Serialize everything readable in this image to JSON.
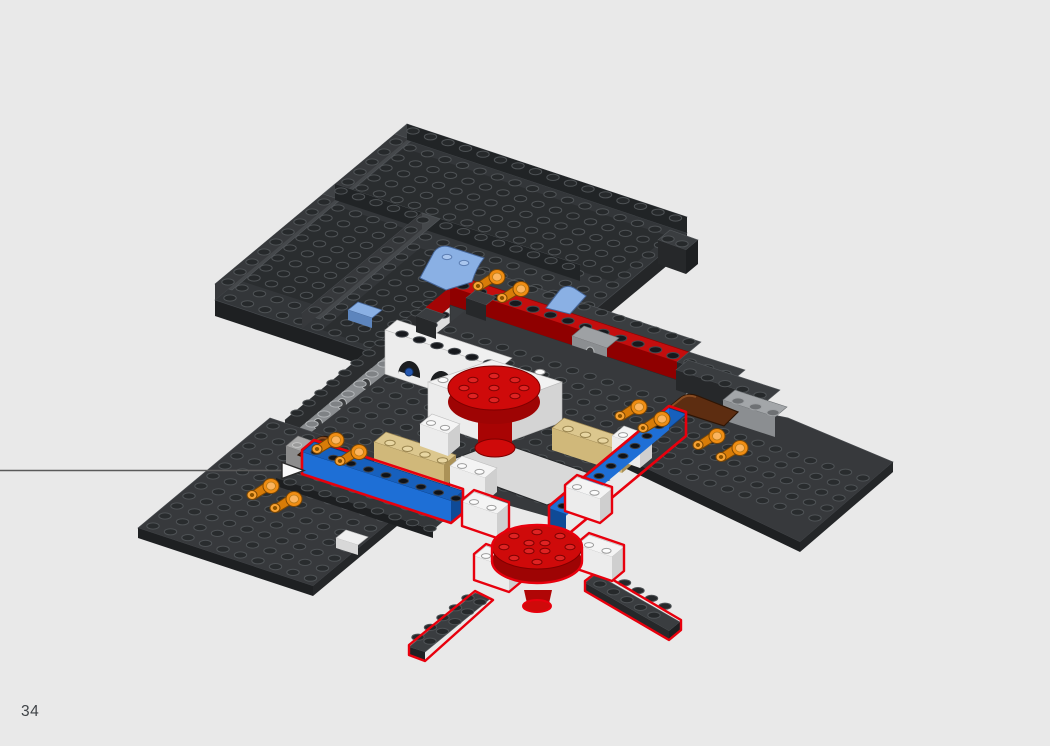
{
  "page": {
    "number": "34"
  },
  "callout": {
    "description": "Line from left page edge with arrowhead pointing at the reddish-brown arch piece behind the left blue wall",
    "line_color": "#5a5a5a",
    "arrowhead_fill": "#fafafa"
  },
  "highlight": {
    "new_part_outline_color": "#e8000d"
  },
  "background_color": "#e9e9e9",
  "model": {
    "description": "Isometric LEGO build step: dark bluish-gray walled baseplates with a central courtyard; newly added parts outlined in red (blue 1x8 walls, white bricks, red round dishes, dark gray plate cross)",
    "parts": [
      {
        "name": "dark-gray-walled-baseplate",
        "color": "#36393b"
      },
      {
        "name": "dark-gray-wing-plates",
        "color": "#36393b"
      },
      {
        "name": "blue-1x8-wall-bricks-new",
        "color": "#1b65c4"
      },
      {
        "name": "white-bricks",
        "color": "#f4f4f4"
      },
      {
        "name": "white-arch-wall",
        "color": "#efefef"
      },
      {
        "name": "tan-1x6-bricks",
        "color": "#dcc78e"
      },
      {
        "name": "red-round-dish-upper",
        "color": "#ce0e0e"
      },
      {
        "name": "red-round-dish-lower-new",
        "color": "#ce0e0e"
      },
      {
        "name": "red-1x8-wall-stripe",
        "color": "#c40e0e"
      },
      {
        "name": "orange-tap-pieces",
        "color": "#f08d13"
      },
      {
        "name": "reddish-brown-arch-pieces",
        "color": "#5d2d11"
      },
      {
        "name": "medium-blue-curved-slopes",
        "color": "#8ab0e4"
      },
      {
        "name": "light-gray-technic-bricks",
        "color": "#9b9ea1"
      },
      {
        "name": "dark-gray-plate-cross-new",
        "color": "#3a3d40"
      }
    ]
  }
}
